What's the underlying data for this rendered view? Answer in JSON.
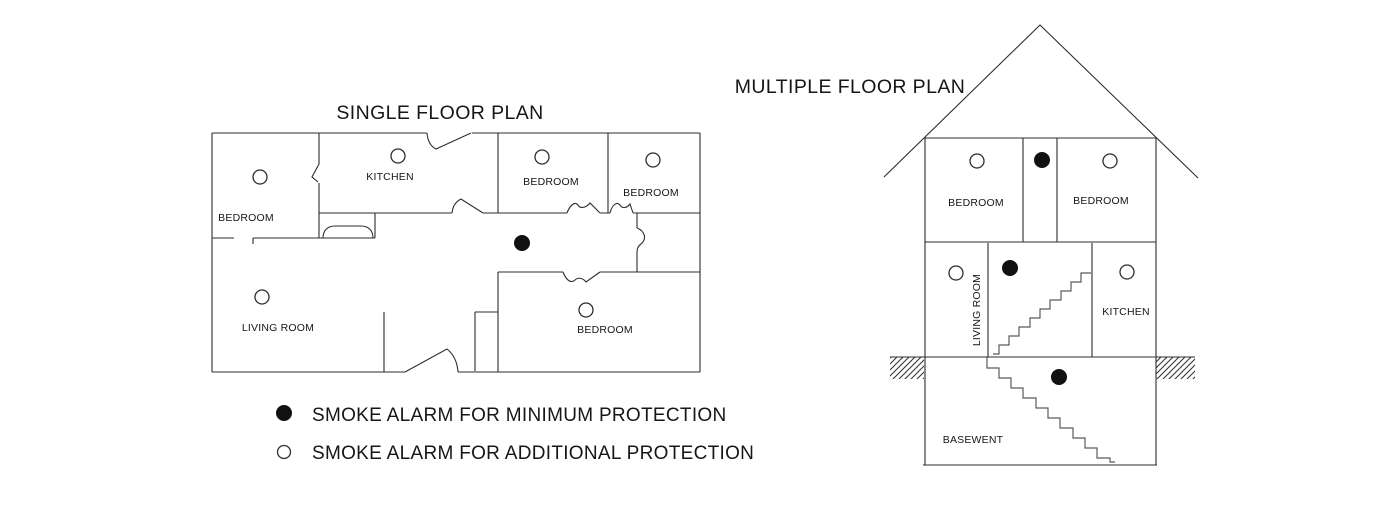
{
  "canvas": {
    "width": 1400,
    "height": 520,
    "background": "#ffffff",
    "line_color": "#2d2d2d"
  },
  "single_floor_plan": {
    "title": "SINGLE FLOOR PLAN",
    "rooms": [
      {
        "name": "BEDROOM"
      },
      {
        "name": "KITCHEN"
      },
      {
        "name": "BEDROOM"
      },
      {
        "name": "BEDROOM"
      },
      {
        "name": "LIVING ROOM"
      },
      {
        "name": "BEDROOM"
      }
    ]
  },
  "multiple_floor_plan": {
    "title": "MULTIPLE FLOOR PLAN",
    "rooms": [
      {
        "name": "BEDROOM"
      },
      {
        "name": "BEDROOM"
      },
      {
        "name": "LIVING ROOM"
      },
      {
        "name": "KITCHEN"
      },
      {
        "name": "BASEWENT"
      }
    ]
  },
  "legend": {
    "items": [
      {
        "symbol": "filled-circle",
        "label": "SMOKE ALARM FOR MINIMUM PROTECTION"
      },
      {
        "symbol": "open-circle",
        "label": "SMOKE ALARM FOR ADDITIONAL PROTECTION"
      }
    ]
  },
  "alarms": [
    {
      "plan": "single",
      "room": "bedroom-top-left",
      "type": "additional",
      "x": 260,
      "y": 177
    },
    {
      "plan": "single",
      "room": "kitchen",
      "type": "additional",
      "x": 398,
      "y": 156
    },
    {
      "plan": "single",
      "room": "bedroom-top-middle",
      "type": "additional",
      "x": 542,
      "y": 157
    },
    {
      "plan": "single",
      "room": "bedroom-top-right",
      "type": "additional",
      "x": 653,
      "y": 160
    },
    {
      "plan": "single",
      "room": "hallway",
      "type": "minimum",
      "x": 522,
      "y": 243
    },
    {
      "plan": "single",
      "room": "living-room",
      "type": "additional",
      "x": 262,
      "y": 297
    },
    {
      "plan": "single",
      "room": "bedroom-bottom",
      "type": "additional",
      "x": 586,
      "y": 310
    },
    {
      "plan": "multiple",
      "room": "bedroom-left",
      "type": "additional",
      "x": 977,
      "y": 161
    },
    {
      "plan": "multiple",
      "room": "upper-hall",
      "type": "minimum",
      "x": 1042,
      "y": 160
    },
    {
      "plan": "multiple",
      "room": "bedroom-right",
      "type": "additional",
      "x": 1110,
      "y": 161
    },
    {
      "plan": "multiple",
      "room": "living-room",
      "type": "additional",
      "x": 956,
      "y": 273
    },
    {
      "plan": "multiple",
      "room": "stair-hall",
      "type": "minimum",
      "x": 1010,
      "y": 268
    },
    {
      "plan": "multiple",
      "room": "kitchen",
      "type": "additional",
      "x": 1127,
      "y": 272
    },
    {
      "plan": "multiple",
      "room": "basement",
      "type": "minimum",
      "x": 1059,
      "y": 377
    }
  ]
}
